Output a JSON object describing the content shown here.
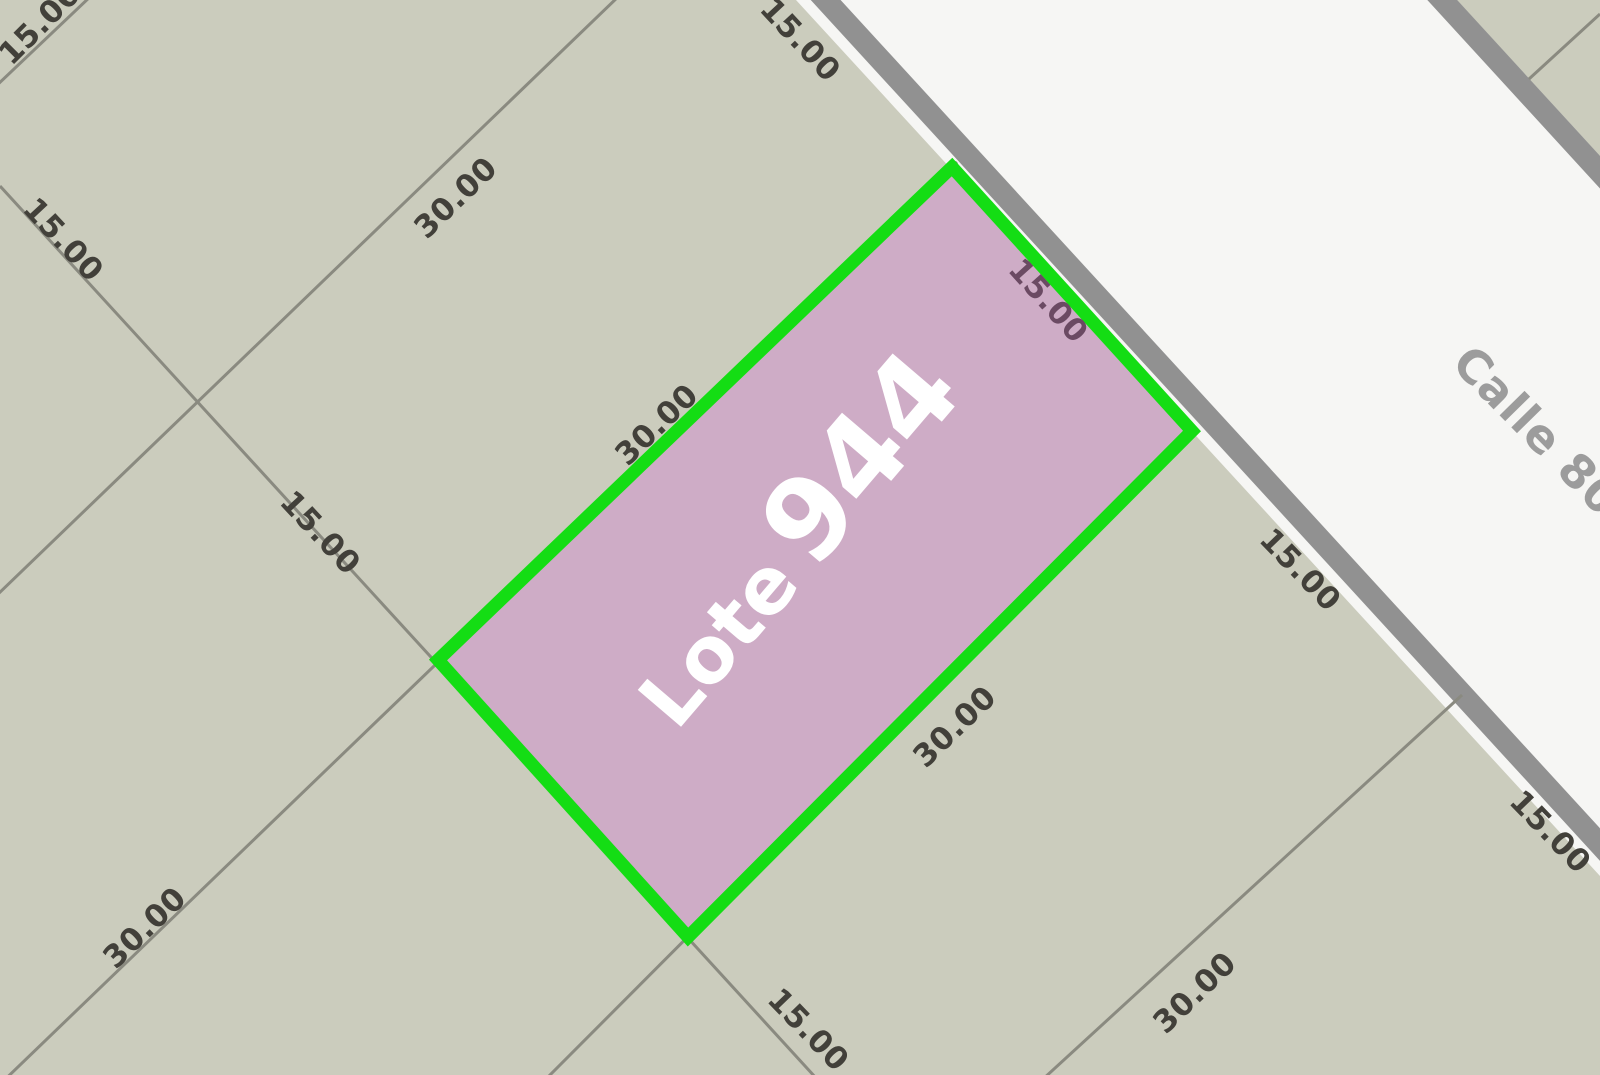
{
  "map": {
    "width": 1600,
    "height": 1075,
    "colors": {
      "street_fill": "#f6f6f4",
      "block_fill": "#cbccbd",
      "street_edge_band": "#919191",
      "parcel_line": "#8a8a80",
      "lot_fill": "#ceacc6",
      "lot_stroke": "#14dd14",
      "dim_text": "#42403a",
      "dim_text_on_lot": "#6b4a63",
      "street_text": "#9c9c9c",
      "lot_text": "#ffffff"
    },
    "blocks": [
      {
        "name": "main-block",
        "points": "0,0 796,0 1600,876 1600,1075 0,1075"
      },
      {
        "name": "far-corner-block",
        "points": "1457,0 1600,0 1600,156"
      }
    ],
    "street_edge_bands": [
      {
        "name": "street-edge-near",
        "x1": 811,
        "y1": -16,
        "x2": 1616,
        "y2": 862,
        "width": 22
      },
      {
        "name": "street-edge-far",
        "x1": 1434,
        "y1": -9,
        "x2": 1620,
        "y2": 194,
        "width": 22
      }
    ],
    "parcel_lines": [
      {
        "name": "side-line-top-left-corner",
        "x1": 92,
        "y1": -5,
        "x2": -5,
        "y2": 87
      },
      {
        "name": "side-line-northwest",
        "x1": 620,
        "y1": -5,
        "x2": -5,
        "y2": 597
      },
      {
        "name": "side-line-lot-northwest",
        "x1": 957,
        "y1": 162,
        "x2": -8,
        "y2": 1092
      },
      {
        "name": "side-line-lot-southeast",
        "x1": 1192,
        "y1": 431,
        "x2": 545,
        "y2": 1080
      },
      {
        "name": "side-line-southeast",
        "x1": 1462,
        "y1": 695,
        "x2": 1042,
        "y2": 1080
      },
      {
        "name": "rear-lot-line",
        "x1": 0,
        "y1": 186,
        "x2": 816,
        "y2": 1078
      },
      {
        "name": "side-line-far-block",
        "x1": 1529,
        "y1": 79,
        "x2": 1600,
        "y2": 14
      }
    ],
    "lot": {
      "id": "944",
      "points": "952,167 1192,431 688,937 438,660",
      "stroke_width": 13,
      "label_small": "Lote",
      "label_big": "944",
      "label_x": 821,
      "label_y": 563,
      "label_rotation": -49.5,
      "label_small_size": 78,
      "label_big_size": 112
    },
    "dimension_labels": [
      {
        "text": "15.00",
        "x": 40,
        "y": 24,
        "rot": -45,
        "on_lot": false
      },
      {
        "text": "15.00",
        "x": 63,
        "y": 240,
        "rot": 47,
        "on_lot": false
      },
      {
        "text": "30.00",
        "x": 456,
        "y": 198,
        "rot": -44,
        "on_lot": false
      },
      {
        "text": "15.00",
        "x": 800,
        "y": 40,
        "rot": 47,
        "on_lot": false
      },
      {
        "text": "30.00",
        "x": 657,
        "y": 425,
        "rot": -44,
        "on_lot": false
      },
      {
        "text": "15.00",
        "x": 320,
        "y": 533,
        "rot": 47,
        "on_lot": false
      },
      {
        "text": "15.00",
        "x": 1048,
        "y": 301,
        "rot": 48,
        "on_lot": true
      },
      {
        "text": "30.00",
        "x": 955,
        "y": 727,
        "rot": -44,
        "on_lot": false
      },
      {
        "text": "15.00",
        "x": 1300,
        "y": 570,
        "rot": 46,
        "on_lot": false
      },
      {
        "text": "15.00",
        "x": 808,
        "y": 1030,
        "rot": 46,
        "on_lot": false
      },
      {
        "text": "30.00",
        "x": 1195,
        "y": 993,
        "rot": -44,
        "on_lot": false
      },
      {
        "text": "15.00",
        "x": 1550,
        "y": 832,
        "rot": 46,
        "on_lot": false
      },
      {
        "text": "30.00",
        "x": 145,
        "y": 928,
        "rot": -44,
        "on_lot": false
      }
    ],
    "dimension_font_size": 31,
    "street_label": {
      "text": "Calle 801 B",
      "x": 1450,
      "y": 365,
      "rot": 45.5,
      "font_size": 46
    }
  }
}
